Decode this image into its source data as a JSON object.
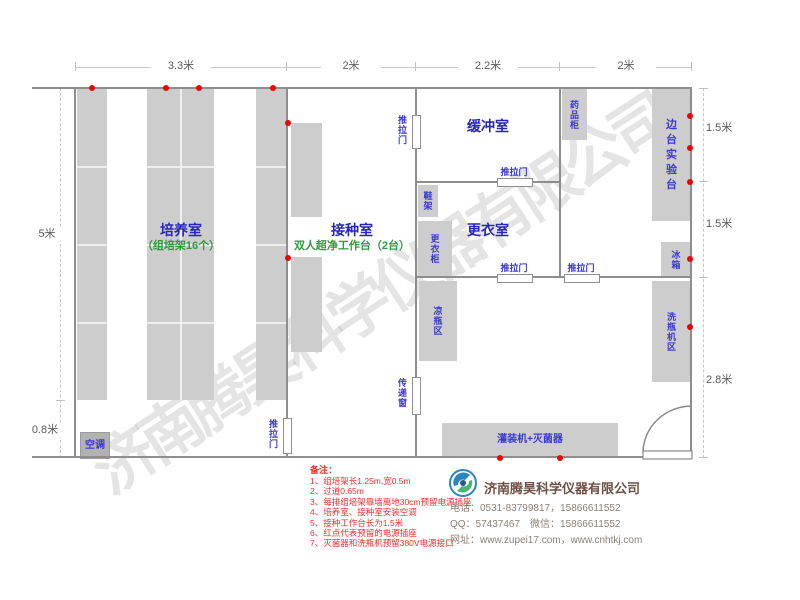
{
  "watermark": "济南腾昊科学仪器有限公司",
  "dimensions": {
    "top": [
      "3.3米",
      "2米",
      "2.2米",
      "2米"
    ],
    "left": [
      "5米",
      "0.8米"
    ],
    "right": [
      "1.5米",
      "1.5米",
      "2.8米"
    ]
  },
  "rooms": {
    "cultivation": {
      "name": "培养室",
      "sub": "（组培架16个）"
    },
    "inoculation": {
      "name": "接种室",
      "sub": "双人超净工作台（2台）"
    },
    "buffer": {
      "name": "缓冲室"
    },
    "dressing": {
      "name": "更衣室"
    }
  },
  "labels": {
    "sliding_door": "推拉门",
    "pass_window": "传递窗",
    "medicine_cabinet": "药品柜",
    "side_bench": "边台实验台",
    "fridge": "冰箱",
    "bottle_washer_area": "洗瓶机区",
    "bottle_cooling_area": "凉瓶区",
    "shoe_rack": "鞋架",
    "wardrobe": "更衣柜",
    "filling_sterilizer": "灌装机+灭菌器",
    "air_conditioner": "空调"
  },
  "notes": {
    "heading": "备注：",
    "items": [
      "1、组培架长1.25m,宽0.5m",
      "2、过道0.65m",
      "3、每排组培架靠墙离地30cm预留电源插座",
      "4、培养室、接种室安装空调",
      "5、接种工作台长为1.5米",
      "6、红点代表预留的电源插座",
      "7、灭菌器和洗瓶机预留380V电源接口"
    ]
  },
  "company": {
    "name": "济南腾昊科学仪器有限公司",
    "phone": "电话：0531-83799817，15866611552",
    "qq_wechat": "QQ：57437467　微信：15866611552",
    "website": "网址：www.zupei17.com，www.cnhtkj.com"
  },
  "colors": {
    "room_label_blue": "#2626bb",
    "sub_label_green": "#2e9a40",
    "furniture_fill": "#cdcdcd",
    "wall_gray": "#8d8d8d",
    "outlet_red": "#f20000",
    "note_red": "#ff2a2a",
    "company_brown": "#6e4f43",
    "contact_gray": "#8d8175"
  }
}
